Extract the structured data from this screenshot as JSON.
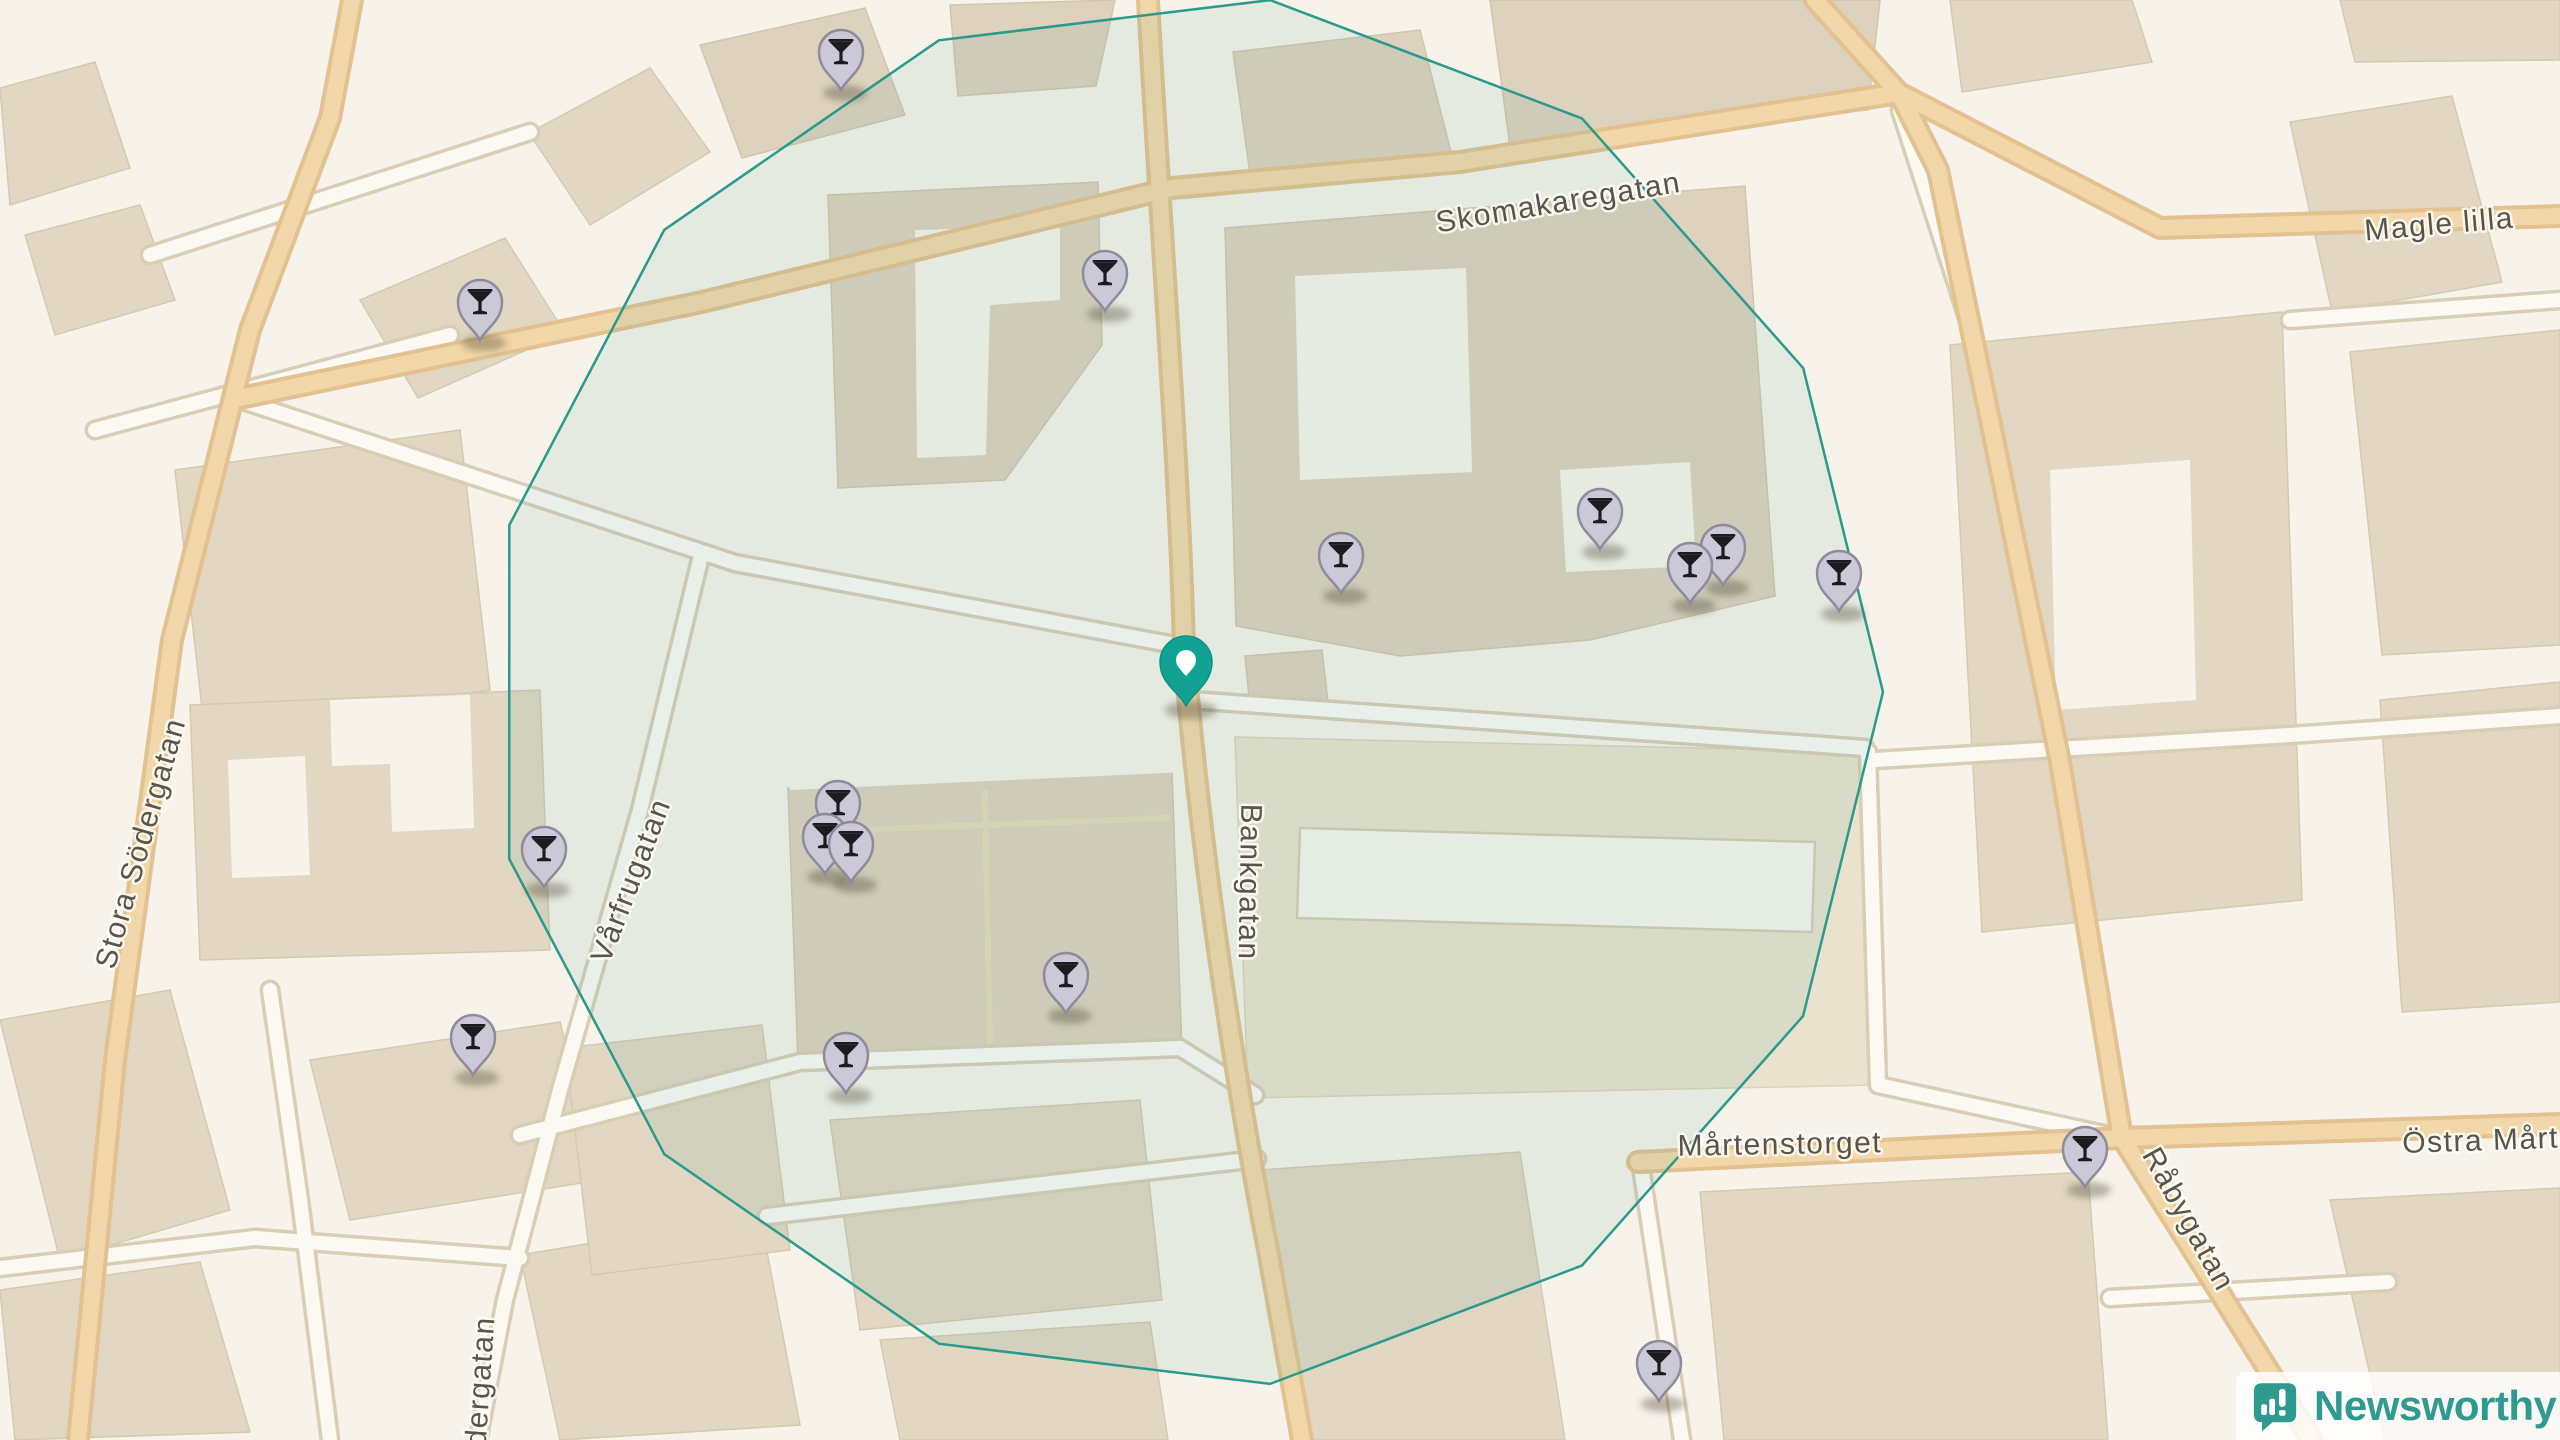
{
  "map": {
    "streets": [
      {
        "label": "Skomakaregatan",
        "x": 1560,
        "y": 212,
        "rotation": -9.5
      },
      {
        "label": "Magle lilla",
        "x": 2440,
        "y": 234,
        "rotation": -5
      },
      {
        "label": "Stora Södergatan",
        "x": 150,
        "y": 846,
        "rotation": -74
      },
      {
        "label": "Vårfrugatan",
        "x": 640,
        "y": 884,
        "rotation": -69
      },
      {
        "label": "Bankgatan",
        "x": 1240,
        "y": 882,
        "rotation": 91
      },
      {
        "label": "Mårtenstorget",
        "x": 1780,
        "y": 1154,
        "rotation": -1
      },
      {
        "label": "Östra Mårte",
        "x": 2490,
        "y": 1150,
        "rotation": -2
      },
      {
        "label": "Råbygatan",
        "x": 2180,
        "y": 1224,
        "rotation": 61
      },
      {
        "label": "dergatan",
        "x": 490,
        "y": 1382,
        "rotation": -86
      }
    ],
    "overlay_circle": {
      "cx": 1186,
      "cy": 692,
      "radius": 697,
      "sides": 13,
      "rotation_deg": 166.15,
      "stroke": "#2a9a8b",
      "fill": "rgba(45,150,138,0.085)"
    },
    "markers": {
      "bar_pin_icon": "martini-glass-icon",
      "bar_pins": [
        {
          "x": 841,
          "y": 90
        },
        {
          "x": 1105,
          "y": 311
        },
        {
          "x": 480,
          "y": 340
        },
        {
          "x": 1600,
          "y": 549
        },
        {
          "x": 1723,
          "y": 585
        },
        {
          "x": 1341,
          "y": 593
        },
        {
          "x": 1690,
          "y": 603
        },
        {
          "x": 1839,
          "y": 611
        },
        {
          "x": 838,
          "y": 841
        },
        {
          "x": 825,
          "y": 874
        },
        {
          "x": 851,
          "y": 882
        },
        {
          "x": 544,
          "y": 887
        },
        {
          "x": 1066,
          "y": 1013
        },
        {
          "x": 473,
          "y": 1075
        },
        {
          "x": 846,
          "y": 1093
        },
        {
          "x": 2085,
          "y": 1187
        },
        {
          "x": 1659,
          "y": 1401
        }
      ],
      "center_pin": {
        "x": 1186,
        "y": 706
      }
    },
    "colors": {
      "bar_pin_fill": "#cbc8d7",
      "bar_pin_stroke": "#8e8b9b",
      "bar_pin_glyph": "#1c1b1f",
      "center_pin_fill": "#12a294",
      "center_pin_stroke": "#0d9185",
      "radius_stroke": "#2a9a8b"
    }
  },
  "logo": {
    "text": "Newsworthy",
    "icon": "newsworthy-bubble-chart-icon",
    "color": "#2f9a8f"
  }
}
